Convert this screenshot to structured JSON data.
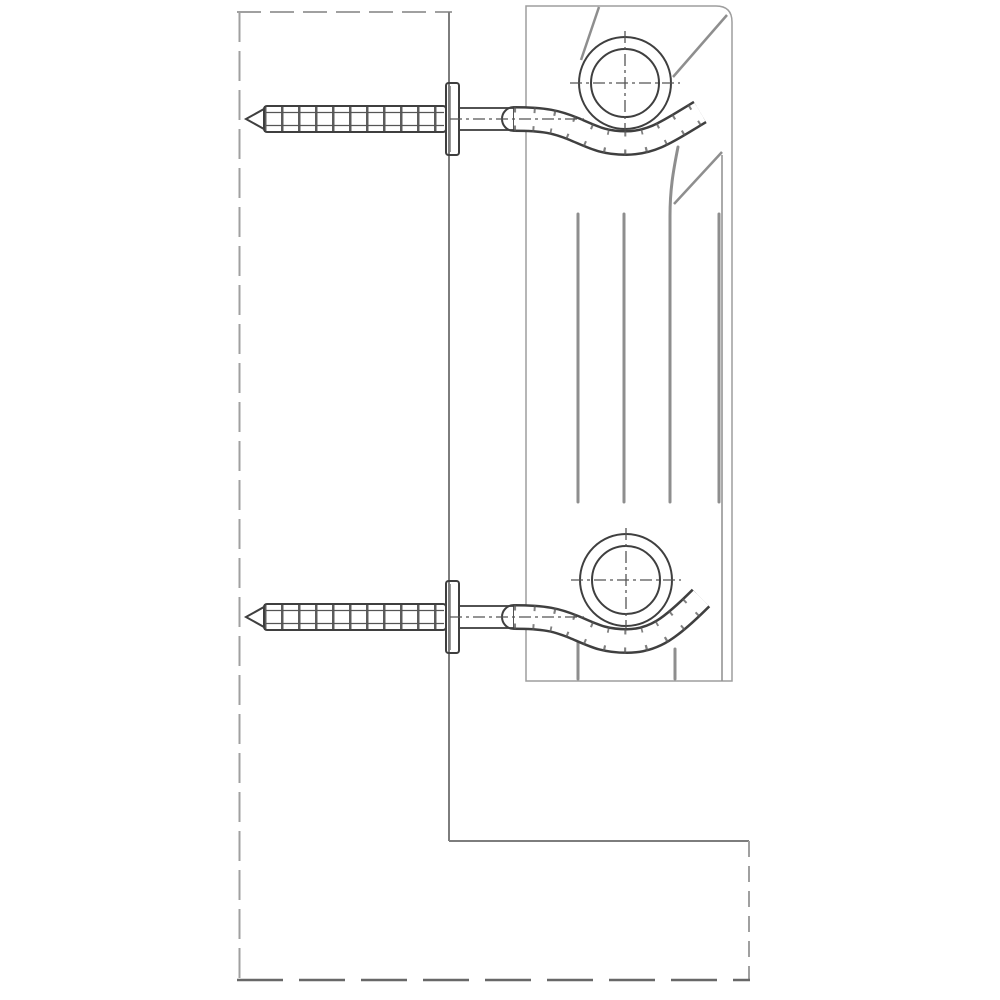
{
  "figure": {
    "type": "diagram",
    "subject": "Cross-section installation drawing: sectional radiator hung on two wall dowel hook brackets above a floor ledge",
    "colors": {
      "letterbox": "#000000",
      "canvas": "#ffffff",
      "hatch": "#9a9a9a",
      "edge-soft": "#a0a0a0",
      "edge-solid": "#7d7d7d",
      "edge-bottom": "#686868",
      "radiator": "#c5c5c6",
      "radiator-shade": "#b1b1b2",
      "radiator-line": "#8e8e8e",
      "ink": "#3f3f3f",
      "ink-mid": "#555555",
      "metal": "#ffffff",
      "pipe-hatch": "#4f4f4f"
    },
    "parts": [
      {
        "name": "wall-cross-section",
        "style": "diagonal dashed masonry hatch"
      },
      {
        "name": "floor-ledge-cross-section",
        "style": "diagonal dashed masonry hatch"
      },
      {
        "name": "radiator-section",
        "style": "gray slab with vertical fins"
      },
      {
        "name": "top-collector-pipe",
        "style": "hatched ring with crosshair"
      },
      {
        "name": "bottom-collector-pipe",
        "style": "hatched ring with crosshair"
      },
      {
        "name": "top-anchor-dowel-screw",
        "style": "ribbed dowel in wall"
      },
      {
        "name": "top-hook-bracket",
        "style": "bent rod cradling collector"
      },
      {
        "name": "bottom-anchor-dowel-screw",
        "style": "ribbed dowel in wall"
      },
      {
        "name": "bottom-hook-bracket",
        "style": "bent rod cradling collector"
      }
    ]
  }
}
